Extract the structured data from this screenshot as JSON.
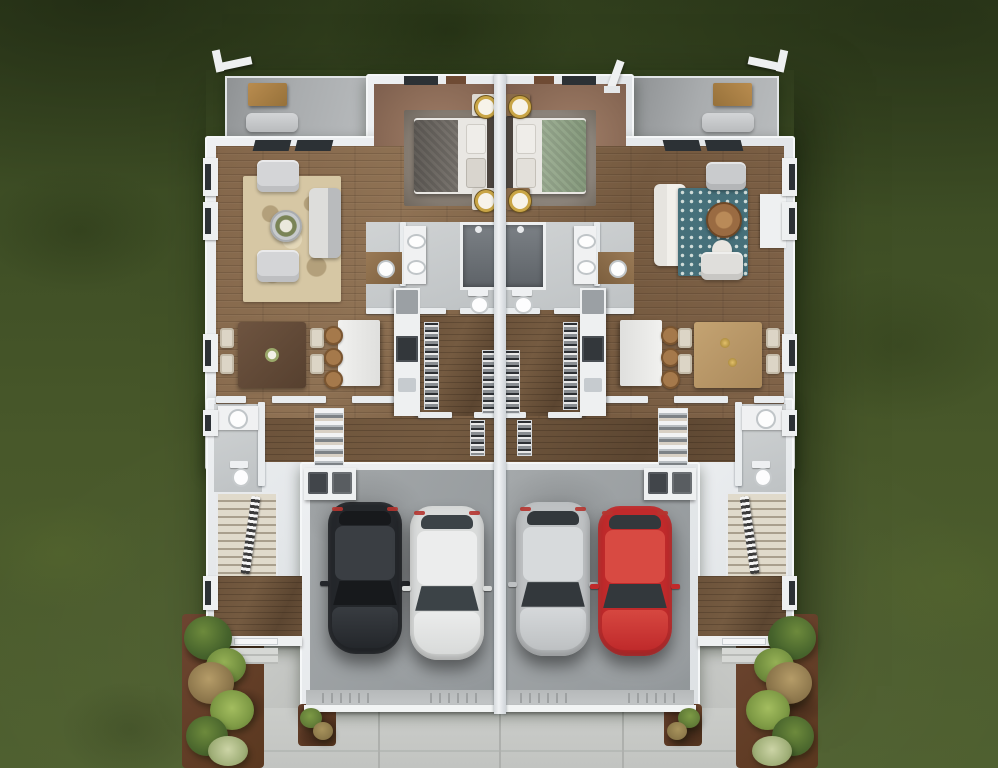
{
  "meta": {
    "description": "Top-down 3D architectural rendering (dollhouse view) of a mirrored two-unit duplex floor plan set on a lawn, with rear patios, one bedroom and bathroom per unit at top center, living rooms on the outer sides, kitchens with islands and walk-in closets in the middle, staircases and entries on the outer edges, attached single garages each holding two cars, landscaped mulch beds and a shared concrete driveway at the bottom",
    "canvas": {
      "width": 998,
      "height": 768
    },
    "render_style": "photoreal 3D floor plan, no text labels"
  },
  "environment": {
    "grass": "#48592b",
    "grass_shadow": "#2f3e1d",
    "driveway": "#c8cac7",
    "walkway": "#c6c8c5",
    "mulch": "#63402c",
    "plant_greens": [
      "#4f6a31",
      "#7d9a45",
      "#a8935c",
      "#b9c49a"
    ]
  },
  "structure": {
    "wall": "#e9ecee",
    "party_wall": "#e9ebed",
    "wood_floor": "#83664a",
    "hall_floor": "#6a533c",
    "bedroom_carpet": "#8e6f5c",
    "bath_tile": "#c9cccd",
    "patio_concrete": "#a6a9ab",
    "garage_floor": "#9aa0a2",
    "stair_tread": "#ddd6c8"
  },
  "rooms": {
    "patio_left": "rear patio (left unit)",
    "patio_right": "rear patio (right unit)",
    "bedroom_left": "bedroom (left unit)",
    "bedroom_right": "bedroom (right unit)",
    "living_left": "living room (left unit)",
    "living_right": "living room (right unit)",
    "dining_left": "dining area (left unit)",
    "dining_right": "dining area (right unit)",
    "kitchen_left": "kitchen (left unit)",
    "kitchen_right": "kitchen (right unit)",
    "closet_left": "walk-in closet (left unit)",
    "closet_right": "walk-in closet (right unit)",
    "bath_left": "bathroom (left unit)",
    "bath_right": "bathroom (right unit)",
    "powder_left": "powder room (left unit)",
    "powder_right": "powder room (right unit)",
    "laundry_left": "washer and dryer (left unit)",
    "laundry_right": "washer and dryer (right unit)",
    "stairs_left": "staircase (left unit)",
    "stairs_right": "staircase (right unit)",
    "entry_left": "front entry (left unit)",
    "entry_right": "front entry (right unit)",
    "garage_left": "garage (left unit)",
    "garage_right": "garage (right unit)"
  },
  "furnishings": {
    "bed_left_blanket": "#7b7670",
    "bed_right_blanket": "#9fb096",
    "rug_left": "#d6c7a4",
    "rug_right": "#46707a",
    "dining_table_left": "#56402f",
    "dining_table_right": "#ab8a5c",
    "sofa_left": "#b9bbbd",
    "sofa_right": "#e6e4df",
    "patio_table_wood": "#b98c4f",
    "lamp_gold": "#c9a546",
    "stool_wood": "#a5794b"
  },
  "vehicles": [
    {
      "name": "black SUV",
      "bay": "left garage, left bay",
      "body": "#24272b",
      "roof": "#3a3e43",
      "glass": "#17191c"
    },
    {
      "name": "white car",
      "bay": "left garage, right bay",
      "body": "#d9dbda",
      "roof": "#eceded",
      "glass": "#3c4347"
    },
    {
      "name": "silver car",
      "bay": "right garage, left bay",
      "body": "#bec1c3",
      "roof": "#d7dadc",
      "glass": "#33383c"
    },
    {
      "name": "red car",
      "bay": "right garage, right bay",
      "body": "#c02a2b",
      "roof": "#d84a42",
      "glass": "#33383c"
    }
  ]
}
